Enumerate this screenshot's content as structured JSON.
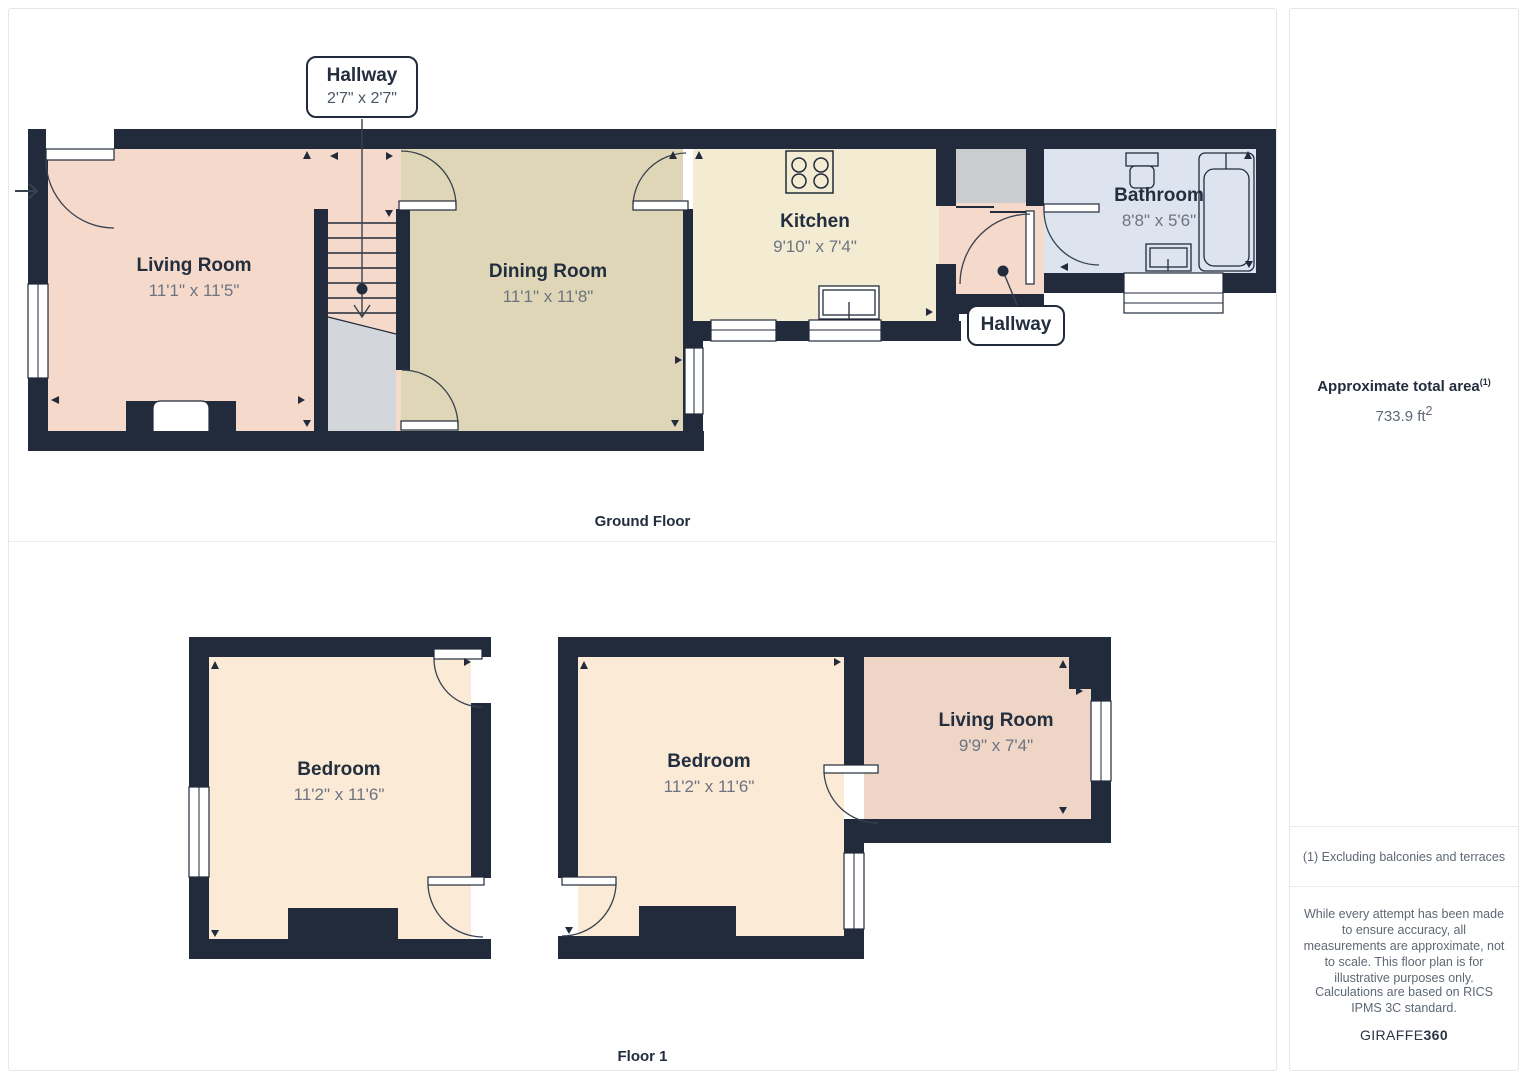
{
  "ground_floor": {
    "label": "Ground Floor",
    "callout_stairs": {
      "name": "Hallway",
      "dims": "2'7\" x 2'7\""
    },
    "callout_rear": {
      "name": "Hallway"
    },
    "rooms": {
      "living": {
        "name": "Living Room",
        "dims": "11'1\" x 11'5\""
      },
      "dining": {
        "name": "Dining Room",
        "dims": "11'1\" x 11'8\""
      },
      "kitchen": {
        "name": "Kitchen",
        "dims": "9'10\" x 7'4\""
      },
      "bathroom": {
        "name": "Bathroom",
        "dims": "8'8\" x 5'6\""
      }
    }
  },
  "floor1": {
    "label": "Floor 1",
    "rooms": {
      "bedroom1": {
        "name": "Bedroom",
        "dims": "11'2\" x 11'6\""
      },
      "bedroom2": {
        "name": "Bedroom",
        "dims": "11'2\" x 11'6\""
      },
      "living": {
        "name": "Living Room",
        "dims": "9'9\" x 7'4\""
      }
    }
  },
  "sidebar": {
    "area_title": "Approximate total area",
    "area_sup": "(1)",
    "area_value": "733.9 ft",
    "area_unit_sup": "2",
    "footnote": "(1) Excluding balconies and terraces",
    "disclaimer1": "While every attempt has been made to ensure accuracy, all measurements are approximate, not to scale. This floor plan is for illustrative purposes only.",
    "disclaimer2": "Calculations are based on RICS IPMS 3C standard.",
    "brand_regular": "GIRAFFE",
    "brand_bold": "360"
  },
  "colors": {
    "wall": "#222b3b",
    "living_gf": "#f5d9ca",
    "dining": "#ded6b6",
    "kitchen": "#f3ecd3",
    "bathroom": "#dde3ef",
    "storage_gray": "#cbccce",
    "under_stairs_gray": "#d3d6db",
    "bedroom": "#fbead6",
    "living_f1": "#eed5c6",
    "label_title": "#232e3f",
    "label_dims": "#6d7480"
  }
}
